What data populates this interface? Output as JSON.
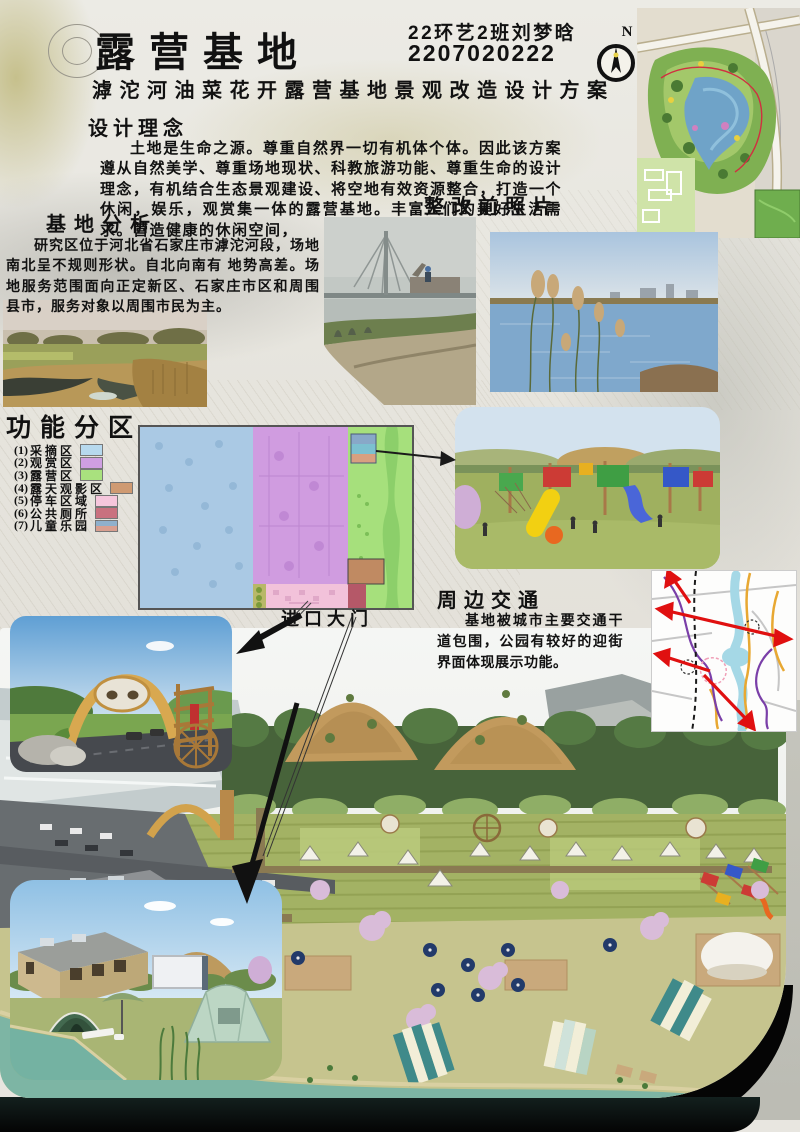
{
  "header": {
    "title": "露营基地",
    "student_class": "22环艺2班刘梦晗",
    "student_id": "2207020222",
    "subtitle": "滹沱河油菜花开露营基地景观改造设计方案",
    "north_label": "N"
  },
  "design_concept": {
    "heading": "设计理念",
    "body": "土地是生命之源。尊重自然界一切有机体个体。因此该方案遵从自然美学、尊重场地现状、科教旅游功能、尊重生命的设计理念，有机结合生态景观建设、将空地有效资源整合，打造一个休闲，娱乐，观赏集一体的露营基地。丰富人们的美好生活需求。营造健康的休闲空间，"
  },
  "before_photos": {
    "heading": "整改前照片"
  },
  "site_analysis": {
    "heading": "基地分析",
    "body": "研究区位于河北省石家庄市滹沱河段，场地南北呈不规则形状。自北向南有 地势高差。场地服务范围面向正定新区、石家庄市区和周围县市，服务对象以周围市民为主。"
  },
  "functional_zones": {
    "heading": "功能分区",
    "items": [
      {
        "no": "(1)",
        "label": "采摘区",
        "color": "#b7d9ee"
      },
      {
        "no": "(2)",
        "label": "观赏区",
        "color": "#cf9fe2"
      },
      {
        "no": "(3)",
        "label": "露营区",
        "color": "#a9e17e"
      },
      {
        "no": "(4)",
        "label": "露天观影区",
        "color": "#cf9a72"
      },
      {
        "no": "(5)",
        "label": "停车区域",
        "color": "#f6c6dc"
      },
      {
        "no": "(6)",
        "label": "公共厕所",
        "color": "#c9717f"
      },
      {
        "no": "(7)",
        "label": "儿童乐园",
        "color": "#8fb0cc",
        "color2": "#d89f90"
      }
    ]
  },
  "entrance": {
    "label": "进口大门"
  },
  "traffic": {
    "heading": "周边交通",
    "body": "基地被城市主要交通干道包围，公园有较好的迎街界面体现展示功能。"
  }
}
